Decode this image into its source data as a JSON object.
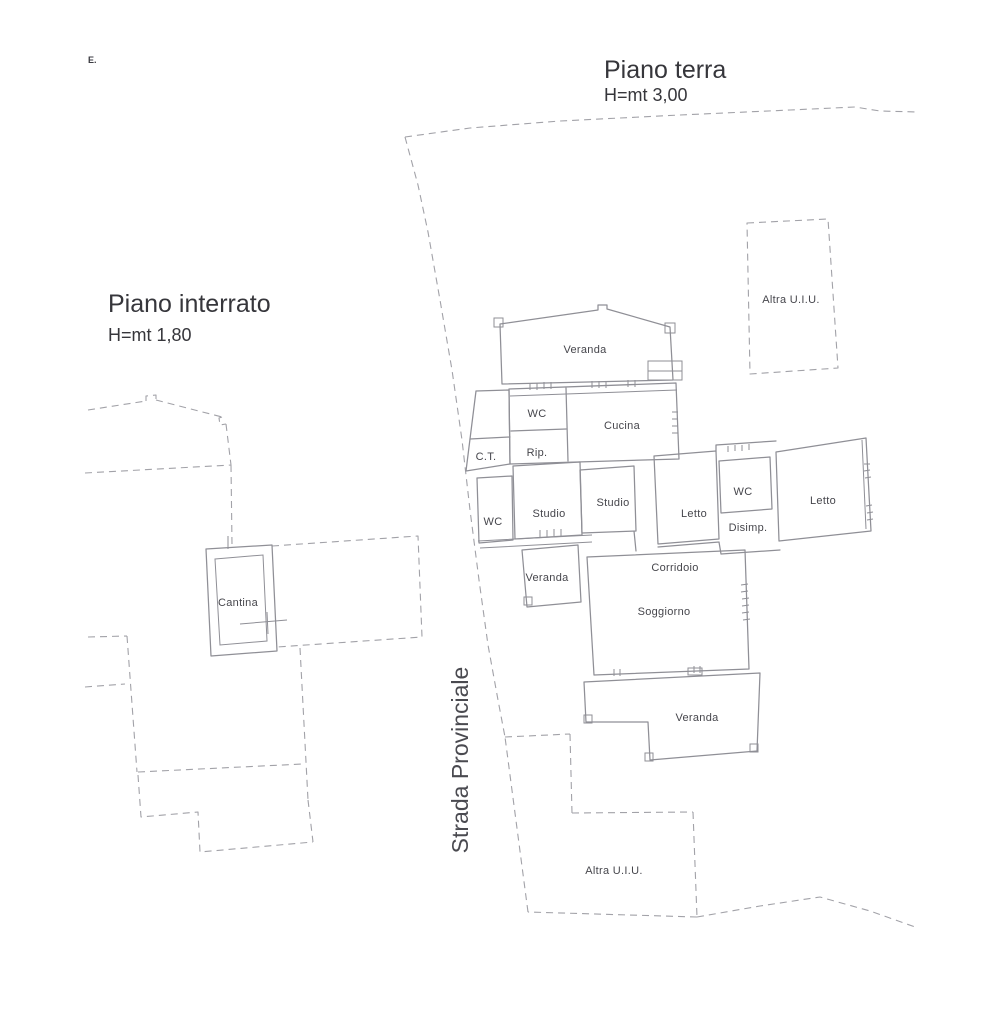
{
  "canvas": {
    "width": 984,
    "height": 1024,
    "background": "#ffffff"
  },
  "colors": {
    "wall": "#8f8f96",
    "boundary": "#a2a2a8",
    "room_label": "#46464c",
    "heading": "#36363b"
  },
  "corner_mark": "E.",
  "floors": {
    "ground": {
      "title": "Piano terra",
      "height_note": "H=mt 3,00"
    },
    "basement": {
      "title": "Piano interrato",
      "height_note": "H=mt 1,80"
    }
  },
  "road": {
    "name": "Strada Provinciale"
  },
  "rooms": {
    "veranda_top": "Veranda",
    "wc_top": "WC",
    "cucina": "Cucina",
    "rip": "Rip.",
    "ct": "C.T.",
    "wc_mid": "WC",
    "studio_left": "Studio",
    "studio_right": "Studio",
    "letto_left": "Letto",
    "wc_right": "WC",
    "disimp": "Disimp.",
    "letto_right": "Letto",
    "veranda_mid": "Veranda",
    "corridoio": "Corridoio",
    "soggiorno": "Soggiorno",
    "veranda_bottom": "Veranda",
    "cantina": "Cantina"
  },
  "annotations": {
    "other_unit_top": "Altra U.I.U.",
    "other_unit_bottom": "Altra U.I.U."
  }
}
